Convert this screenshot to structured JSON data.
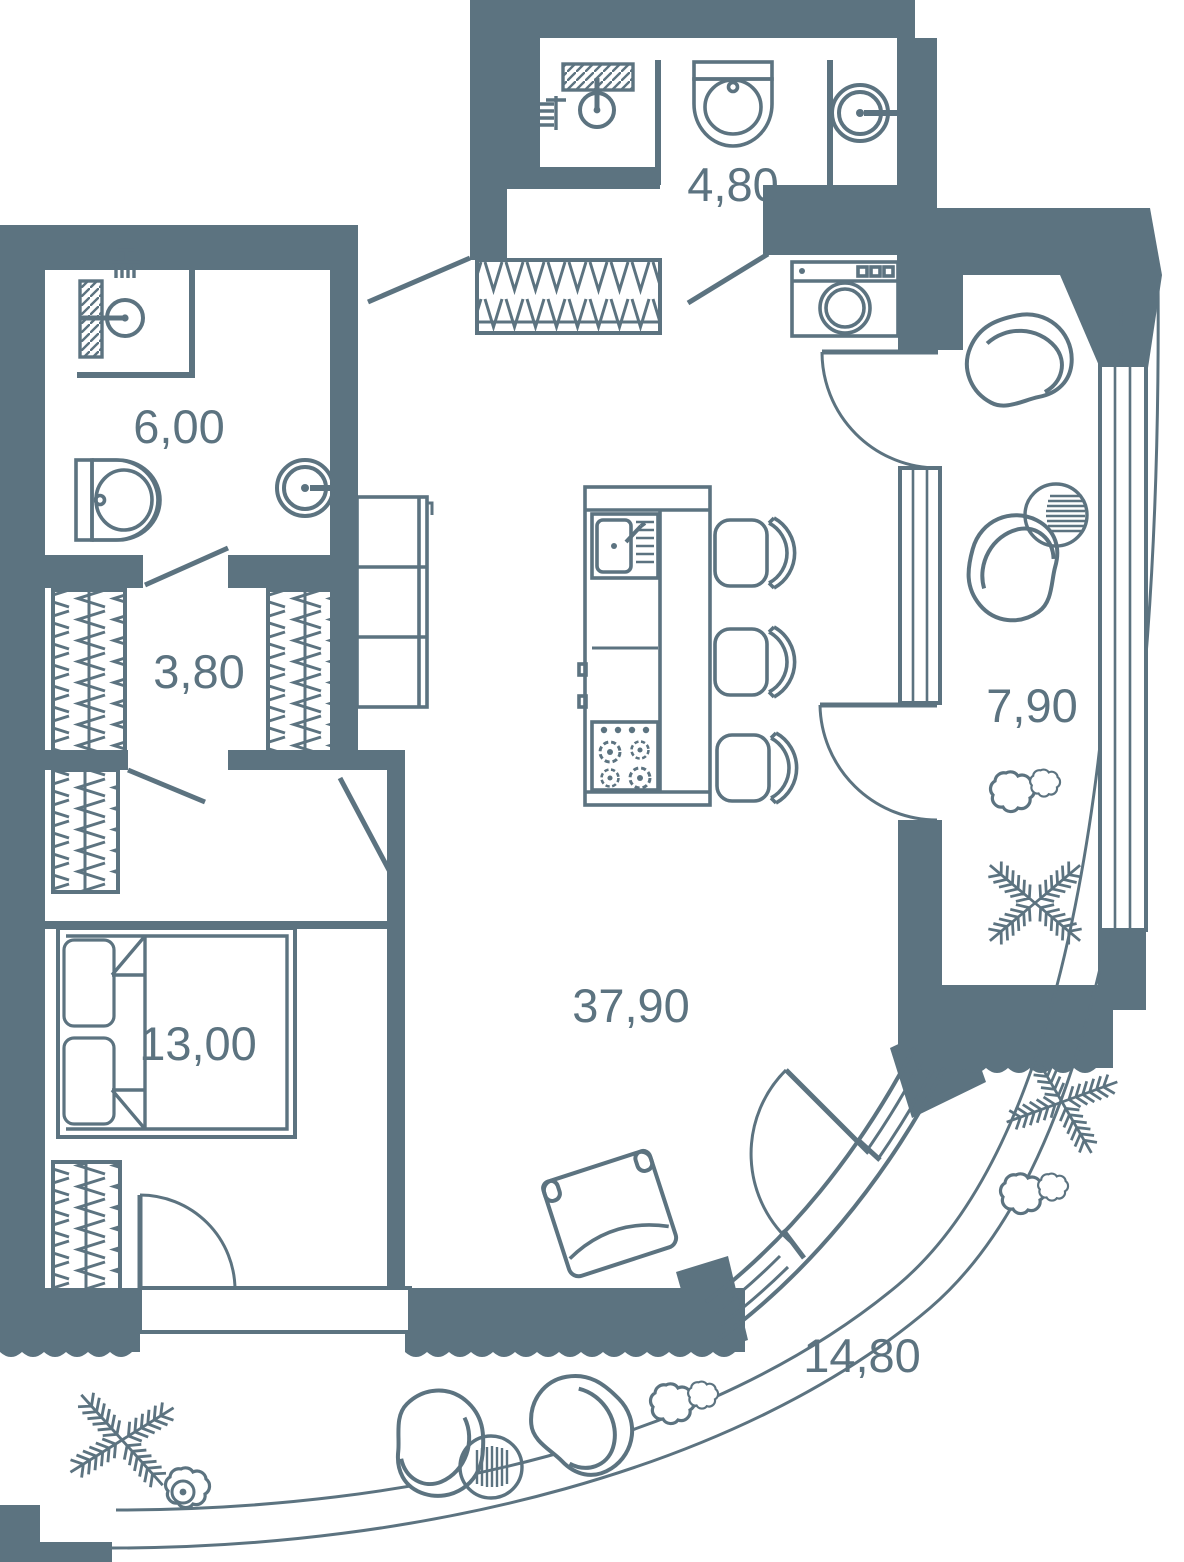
{
  "plan": {
    "type": "apartment-floor-plan",
    "colors": {
      "wall": "#5C7380",
      "line": "#5C7380",
      "background": "#FFFFFF"
    },
    "rooms": [
      {
        "id": "bathroom-top",
        "area_label": "4,80"
      },
      {
        "id": "bathroom-left",
        "area_label": "6,00"
      },
      {
        "id": "hallway",
        "area_label": "3,80"
      },
      {
        "id": "bedroom",
        "area_label": "13,00"
      },
      {
        "id": "living-kitchen",
        "area_label": "37,90"
      },
      {
        "id": "loggia-right",
        "area_label": "7,90"
      },
      {
        "id": "terrace-curved",
        "area_label": "14,80"
      }
    ]
  }
}
